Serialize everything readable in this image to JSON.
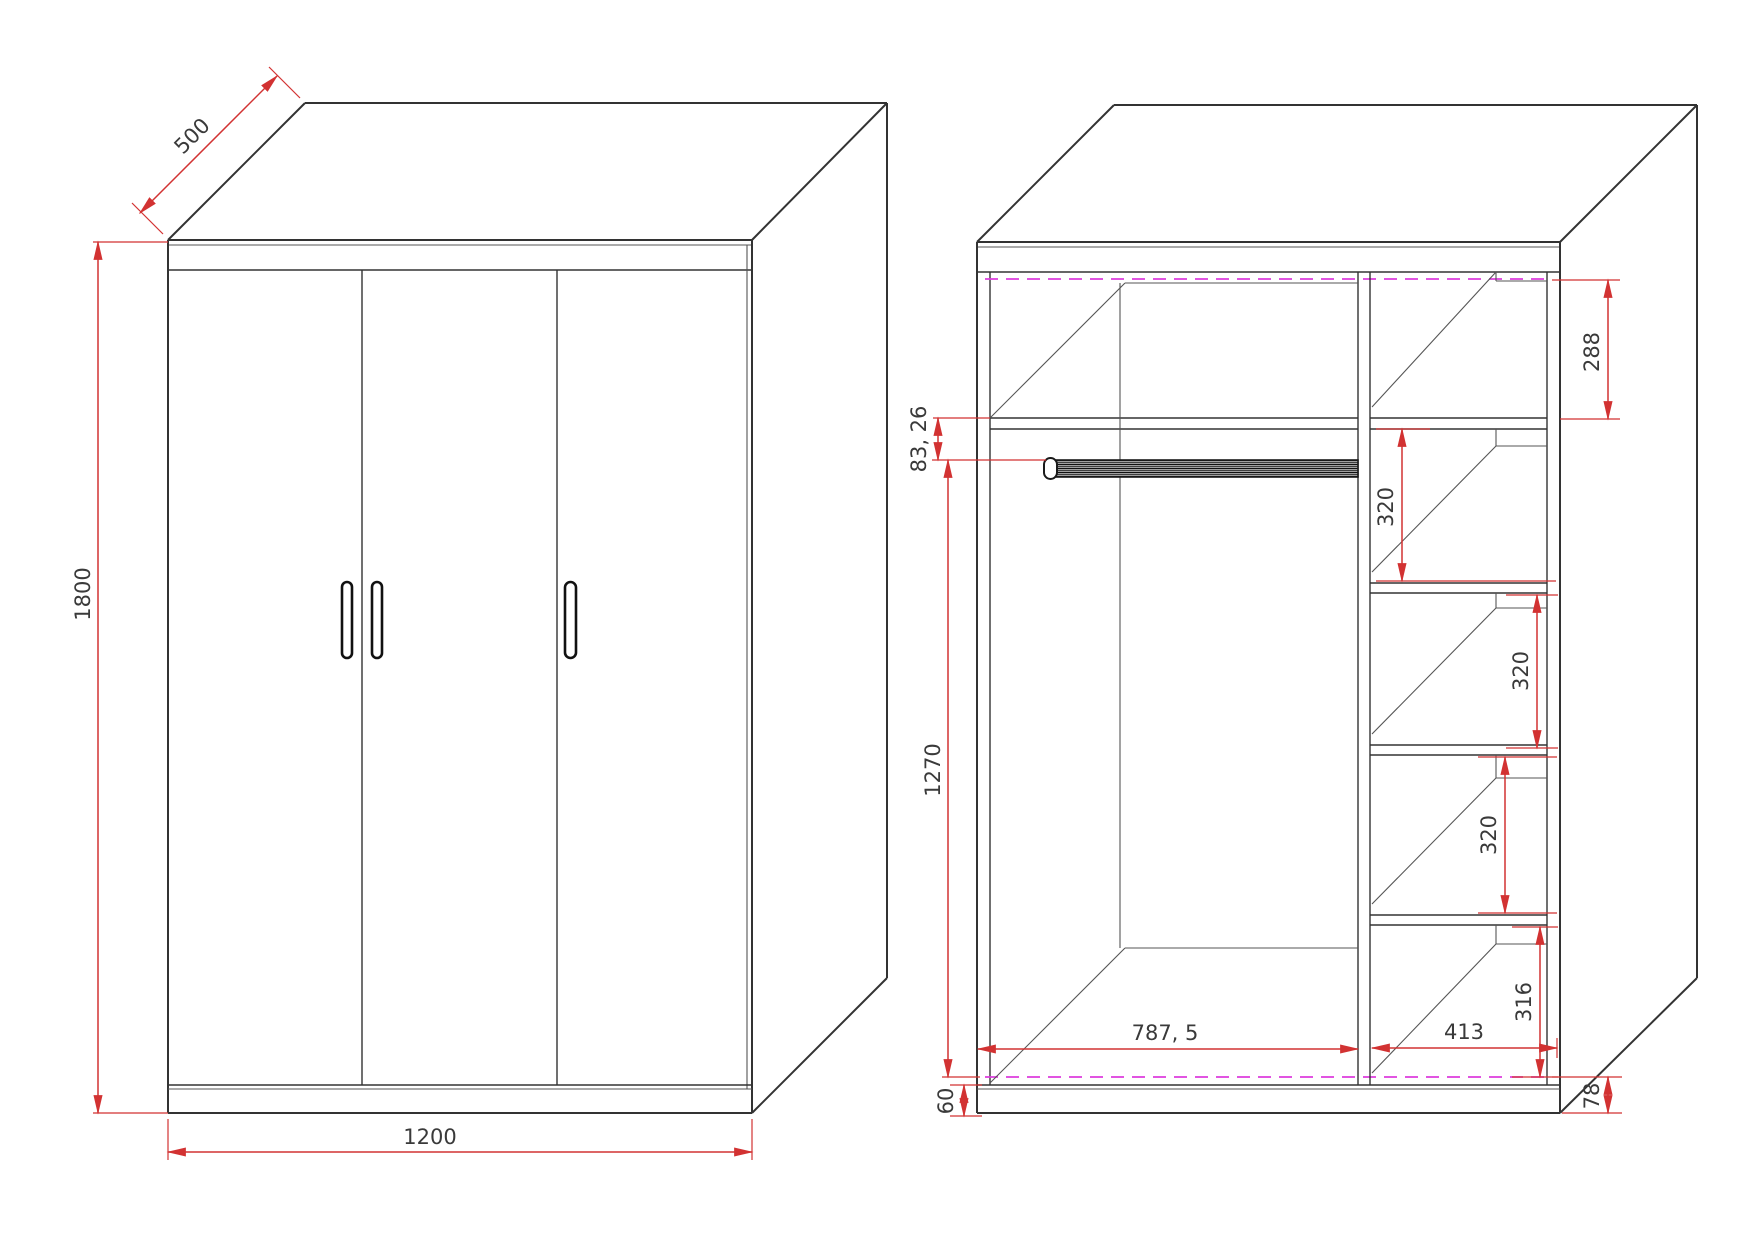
{
  "colors": {
    "dim-red": "#d23232",
    "line-dark": "#333333",
    "back-panel-magenta": "#dd3cdd",
    "label-gray": "#3a3a3a"
  },
  "front_view": {
    "dims": {
      "depth": "500",
      "height": "1800",
      "width": "1200"
    }
  },
  "interior_view": {
    "dims": {
      "rod_offset": "83, 26",
      "hanging_height": "1270",
      "top_compartment": "288",
      "shelf_gap_1": "320",
      "shelf_gap_2": "320",
      "shelf_gap_3": "320",
      "bottom_compartment": "316",
      "left_section_width": "787, 5",
      "right_section_width": "413",
      "plinth_left": "60",
      "plinth_right": "78"
    }
  }
}
